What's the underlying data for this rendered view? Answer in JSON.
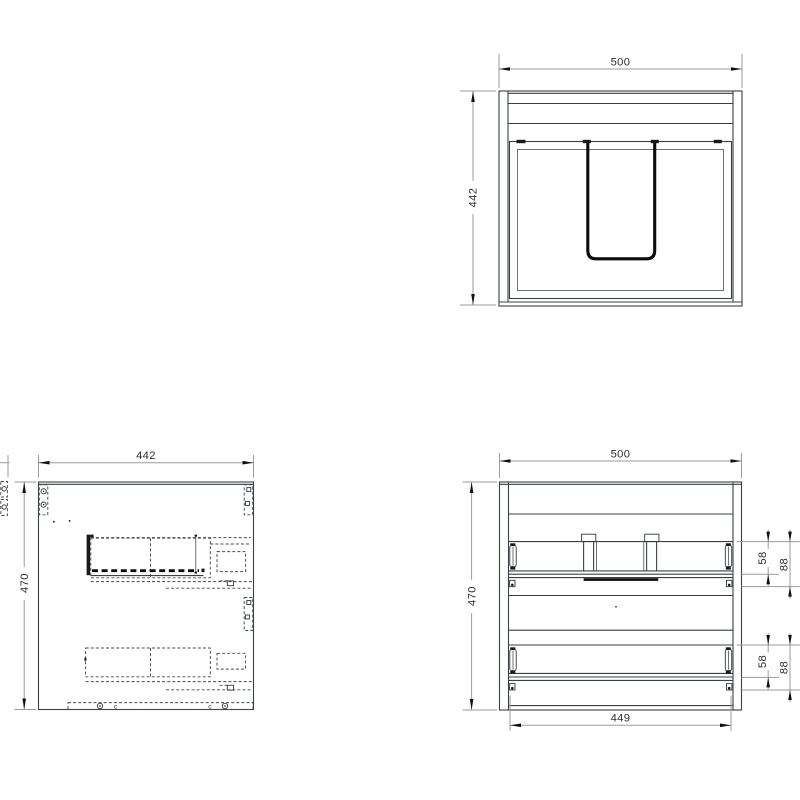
{
  "drawing": {
    "type": "cad-orthographic-views",
    "top_view": {
      "width": "500",
      "depth": "442"
    },
    "side_view": {
      "depth": "442",
      "height": "470",
      "marker_left": "c",
      "marker_right": "c"
    },
    "front_view": {
      "width": "500",
      "height": "470",
      "inner_width": "449",
      "top_drawer": {
        "front_height": "58",
        "total_height": "88"
      },
      "bottom_drawer": {
        "front_height": "58",
        "total_height": "88"
      }
    },
    "colors": {
      "background": "#ffffff",
      "object_line": "#3b4045",
      "dimension_line": "#9b9b9b",
      "highlight_line": "#0c0c0c",
      "text": "#2e2e2e"
    }
  }
}
